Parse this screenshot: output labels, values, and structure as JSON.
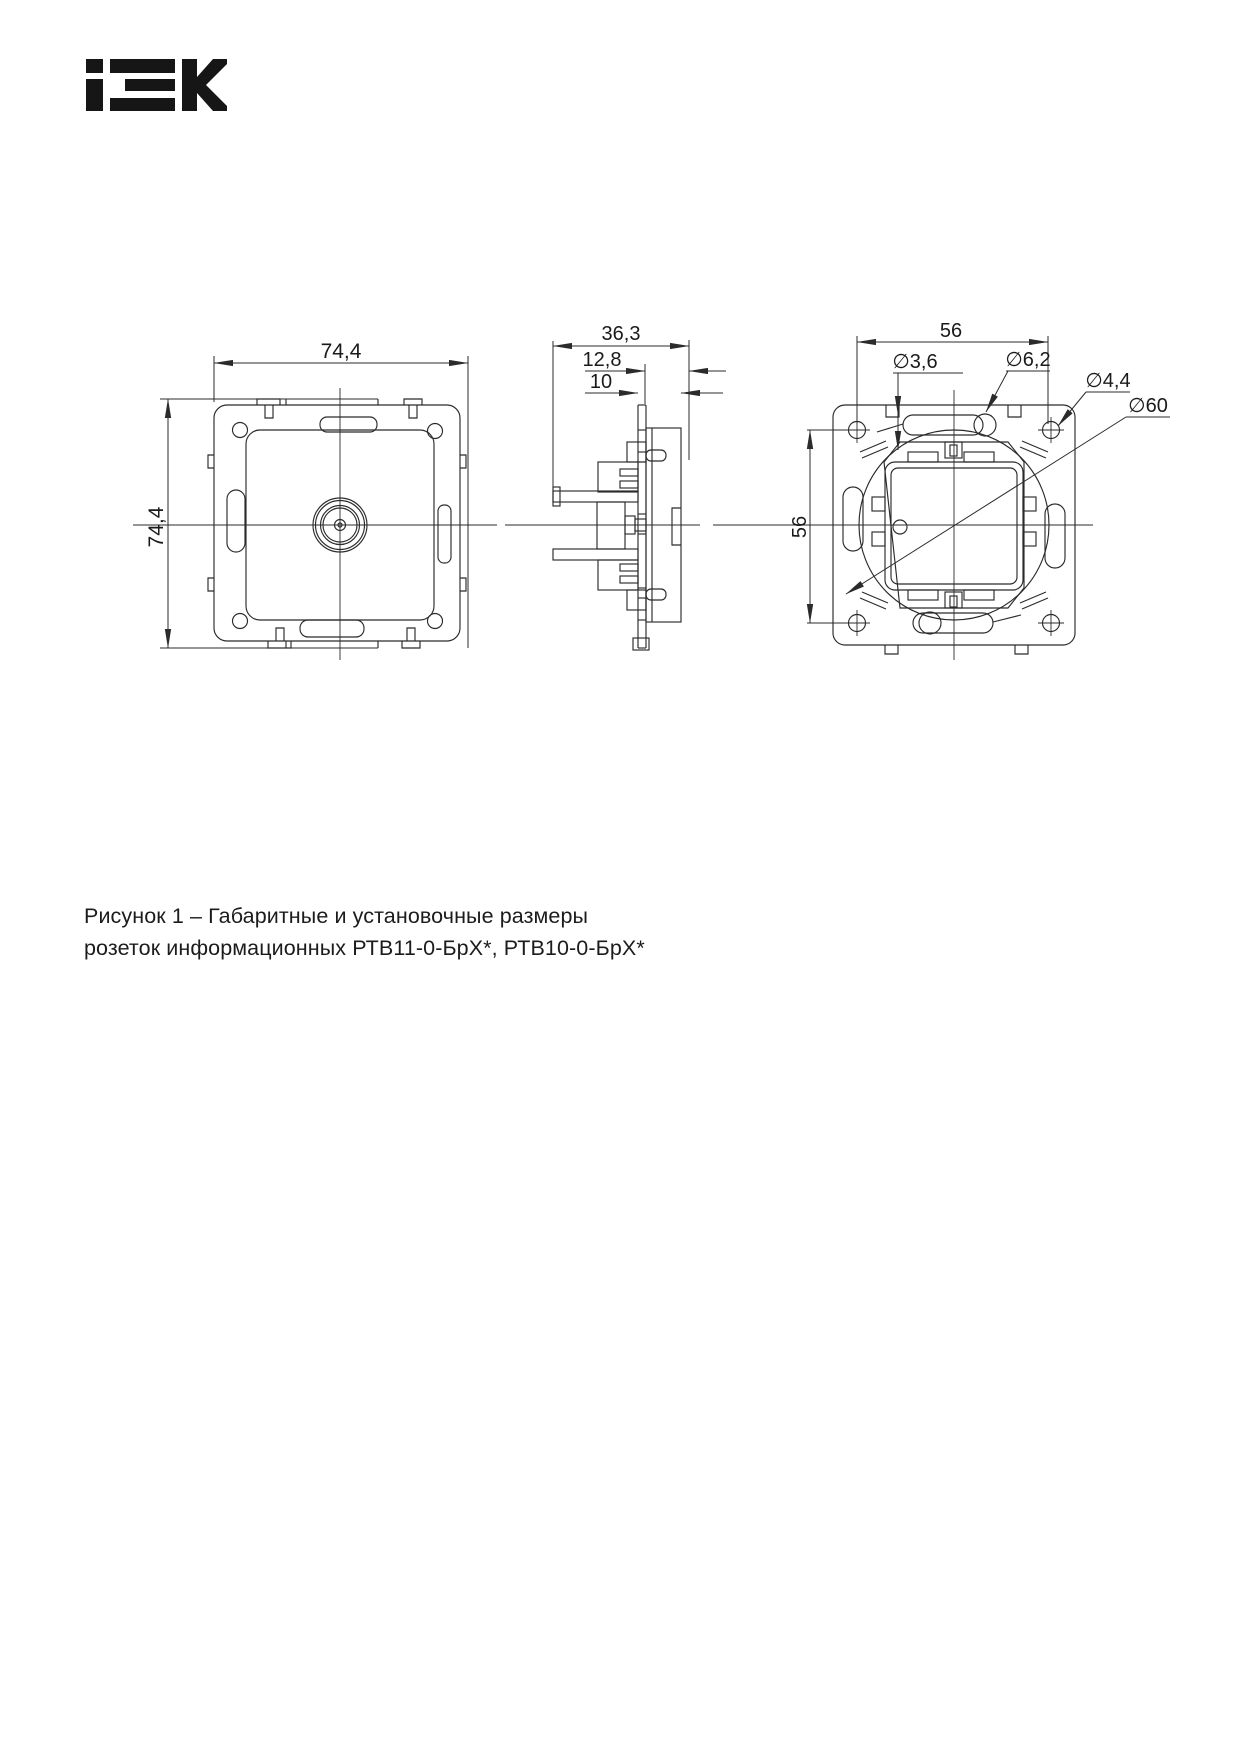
{
  "page": {
    "background": "#ffffff"
  },
  "logo": {
    "text": "IEK"
  },
  "drawing": {
    "front_view": {
      "dim_width": "74,4",
      "dim_height": "74,4"
    },
    "side_view": {
      "dim_depth_total": "36,3",
      "dim_depth_mid": "12,8",
      "dim_depth_front": "10"
    },
    "rear_view": {
      "dim_width": "56",
      "dim_height": "56",
      "dia_pilot_hole": "∅3,6",
      "dia_claw_hole": "∅6,2",
      "dia_screw_hole": "∅4,4",
      "dia_mounting_circle": "∅60"
    }
  },
  "caption": {
    "line1": "Рисунок 1 – Габаритные и установочные размеры",
    "line2": "розеток информационных РТВ11-0-БрХ*, РТВ10-0-БрХ*"
  },
  "colors": {
    "line": "#2b2b2b",
    "text": "#1a1a1a",
    "logo": "#161616"
  }
}
